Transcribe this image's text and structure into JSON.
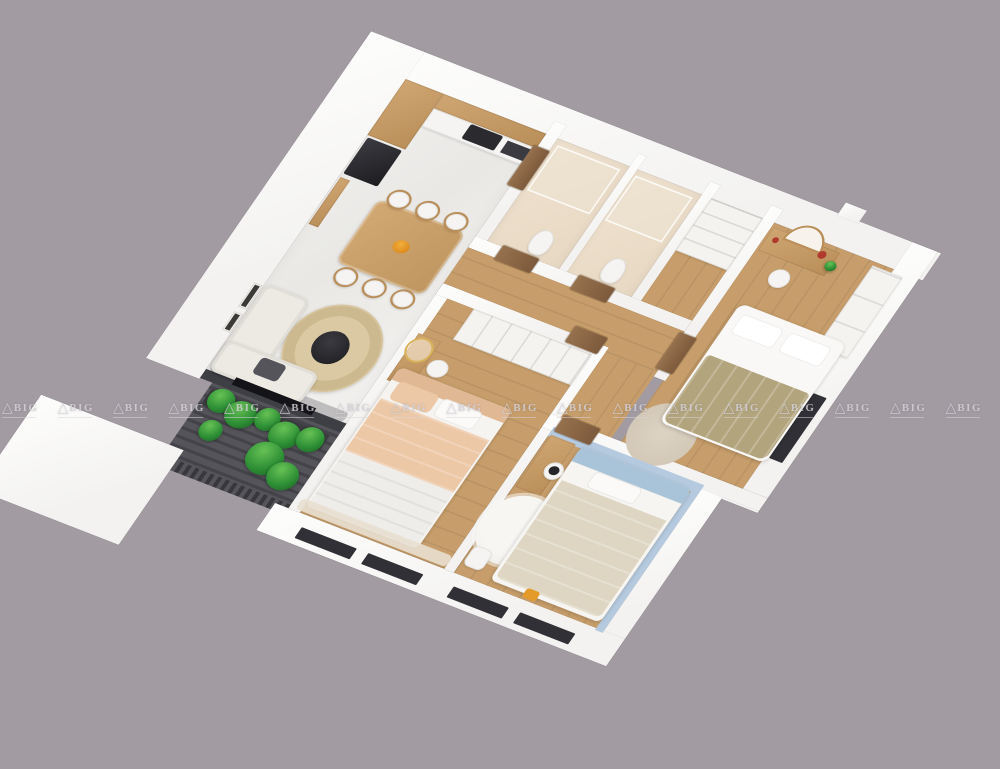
{
  "scene": {
    "description": "3D axonometric render of a 3-room apartment floor plan, white walls, wood floors, gray studio background",
    "rooms": [
      "kitchen",
      "dining-area",
      "living-room",
      "balcony",
      "bathroom-a",
      "bathroom-b",
      "storage",
      "hallway",
      "master-bedroom",
      "second-bedroom",
      "kids-bedroom"
    ]
  },
  "watermark": {
    "brand": "ABIG",
    "mark_glyph": "△",
    "logo_text": "BIG",
    "count": 18
  },
  "palette": {
    "bg": "#a29ba2",
    "wall": "#f3f2f0",
    "wall-bright": "#fdfdfc",
    "wood-floor": "#c79e6b",
    "wood-cabinet": "#c19466",
    "door-wood": "#8a6747",
    "appliance-black": "#26262a",
    "bath-floor": "#ebddc8",
    "sofa-white": "#edeae3",
    "cushion-gray": "#55545a",
    "rug-jute": "#d8c7a1",
    "plant-green": "#2f9136",
    "balcony-deck": "#4b4b51",
    "master-blanket-olive": "#b2a47c",
    "bed2-peach": "#ecc8a6",
    "kids-blue": "#b5cadf",
    "kids-bedding": "#ded5c2",
    "fluffy-rug": "#f2f0ed",
    "accent-orange": "#e59b2a",
    "decor-red": "#b03a2e",
    "wm": "rgba(216,212,219,0.8)"
  }
}
